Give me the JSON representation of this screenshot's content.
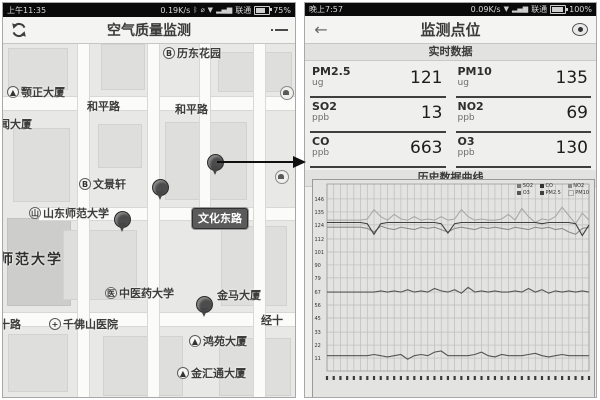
{
  "left_phone": {
    "status_bar": {
      "time": "上午11:35",
      "net_speed": "0.19K/s",
      "carrier": "联通",
      "battery": "75%"
    },
    "title_bar": {
      "title": "空气质量监测"
    },
    "map": {
      "road_badge": {
        "text": "文化东路",
        "x": 189,
        "y": 164
      },
      "labels": [
        {
          "text": "历东花园",
          "icon": "B",
          "x": 160,
          "y": 1
        },
        {
          "text": "颚正大厦",
          "icon": "▲",
          "x": 4,
          "y": 40
        },
        {
          "text": "和平路",
          "x": 84,
          "y": 54
        },
        {
          "text": "和平路",
          "x": 172,
          "y": 57
        },
        {
          "text": "闻大厦",
          "x": -4,
          "y": 72
        },
        {
          "text": "文景轩",
          "icon": "B",
          "x": 76,
          "y": 132
        },
        {
          "text": "山东师范大学",
          "icon": "山",
          "x": 26,
          "y": 161
        },
        {
          "text": "师范大学",
          "x": -4,
          "y": 205,
          "big": true
        },
        {
          "text": "中医药大学",
          "icon": "医",
          "x": 102,
          "y": 241
        },
        {
          "text": "金马大厦",
          "x": 214,
          "y": 243
        },
        {
          "text": "十路",
          "x": -4,
          "y": 272
        },
        {
          "text": "千佛山医院",
          "icon": "+",
          "x": 46,
          "y": 272
        },
        {
          "text": "经十",
          "x": 258,
          "y": 268
        },
        {
          "text": "鸿苑大厦",
          "icon": "▲",
          "x": 186,
          "y": 289
        },
        {
          "text": "金汇通大厦",
          "icon": "▲",
          "x": 174,
          "y": 321
        }
      ],
      "pins": [
        {
          "x": 204,
          "y": 110
        },
        {
          "x": 149,
          "y": 135
        },
        {
          "x": 111,
          "y": 167
        },
        {
          "x": 193,
          "y": 252
        }
      ],
      "poi_dots": [
        {
          "x": 272,
          "y": 126
        },
        {
          "x": 277,
          "y": 42
        }
      ]
    }
  },
  "right_phone": {
    "status_bar": {
      "time": "晚上7:57",
      "net_speed": "0.09K/s",
      "carrier": "联通",
      "battery": "100%"
    },
    "title_bar": {
      "title": "监测点位"
    },
    "realtime": {
      "header": "实时数据",
      "cells": [
        {
          "label": "PM2.5",
          "unit": "ug",
          "value": "121"
        },
        {
          "label": "PM10",
          "unit": "ug",
          "value": "135"
        },
        {
          "label": "SO2",
          "unit": "ppb",
          "value": "13"
        },
        {
          "label": "NO2",
          "unit": "ppb",
          "value": "69"
        },
        {
          "label": "CO",
          "unit": "ppb",
          "value": "663"
        },
        {
          "label": "O3",
          "unit": "ppb",
          "value": "130"
        }
      ]
    },
    "history": {
      "header": "历史数据曲线"
    }
  },
  "chart_data": {
    "type": "line",
    "title": "历史数据曲线",
    "x_count": 40,
    "x_tick_labels_visible": false,
    "ylim": [
      0,
      157
    ],
    "yticks": [
      146,
      135,
      124,
      112,
      101,
      90,
      79,
      67,
      56,
      45,
      33,
      22,
      11
    ],
    "grid": true,
    "legend_position": "top-right",
    "legend": [
      {
        "name": "SO2",
        "color": "#777777",
        "filled": true
      },
      {
        "name": "CO",
        "color": "#333333",
        "filled": true
      },
      {
        "name": "NO2",
        "color": "#888888",
        "filled": true
      },
      {
        "name": "O3",
        "color": "#555555",
        "filled": true
      },
      {
        "name": "PM2.5",
        "color": "#3f3f3f",
        "filled": true
      },
      {
        "name": "PM10",
        "color": "#aaaaaa",
        "filled": false
      }
    ],
    "series": [
      {
        "name": "PM10",
        "color": "#a9a9a7",
        "values": [
          128,
          128,
          128,
          128,
          128,
          128,
          129,
          137,
          131,
          128,
          133,
          129,
          128,
          131,
          128,
          129,
          128,
          131,
          128,
          129,
          137,
          131,
          128,
          129,
          128,
          128,
          129,
          133,
          128,
          138,
          131,
          126,
          129,
          128,
          131,
          139,
          132,
          125,
          134,
          128
        ]
      },
      {
        "name": "O3",
        "color": "#8d8d8b",
        "values": [
          122,
          122,
          122,
          122,
          122,
          122,
          121,
          118,
          123,
          121,
          120,
          122,
          121,
          120,
          122,
          121,
          122,
          120,
          118,
          121,
          122,
          121,
          120,
          122,
          121,
          122,
          121,
          120,
          122,
          121,
          120,
          122,
          121,
          122,
          120,
          121,
          118,
          116,
          121,
          122
        ]
      },
      {
        "name": "PM2.5",
        "color": "#3f3f3f",
        "values": [
          126,
          126,
          126,
          126,
          126,
          126,
          125,
          116,
          125,
          126,
          126,
          126,
          126,
          126,
          126,
          126,
          126,
          125,
          117,
          125,
          126,
          126,
          126,
          126,
          126,
          126,
          126,
          126,
          126,
          126,
          126,
          126,
          125,
          126,
          126,
          126,
          126,
          125,
          115,
          124
        ]
      },
      {
        "name": "NO2",
        "color": "#545454",
        "values": [
          67,
          67,
          67,
          67,
          67,
          67,
          67,
          67,
          68,
          67,
          68,
          67,
          69,
          67,
          68,
          67,
          70,
          68,
          67,
          69,
          66,
          71,
          67,
          68,
          67,
          68,
          67,
          67,
          68,
          67,
          70,
          67,
          69,
          66,
          68,
          67,
          68,
          67,
          68,
          67
        ]
      },
      {
        "name": "SO2",
        "color": "#545454",
        "values": [
          13,
          13,
          13,
          13,
          13,
          13,
          13,
          14,
          13,
          12,
          13,
          14,
          10,
          13,
          14,
          13,
          16,
          17,
          13,
          13,
          13,
          13,
          14,
          16,
          13,
          12,
          14,
          13,
          13,
          13,
          14,
          15,
          13,
          12,
          13,
          14,
          13,
          13,
          13,
          13
        ]
      }
    ]
  }
}
